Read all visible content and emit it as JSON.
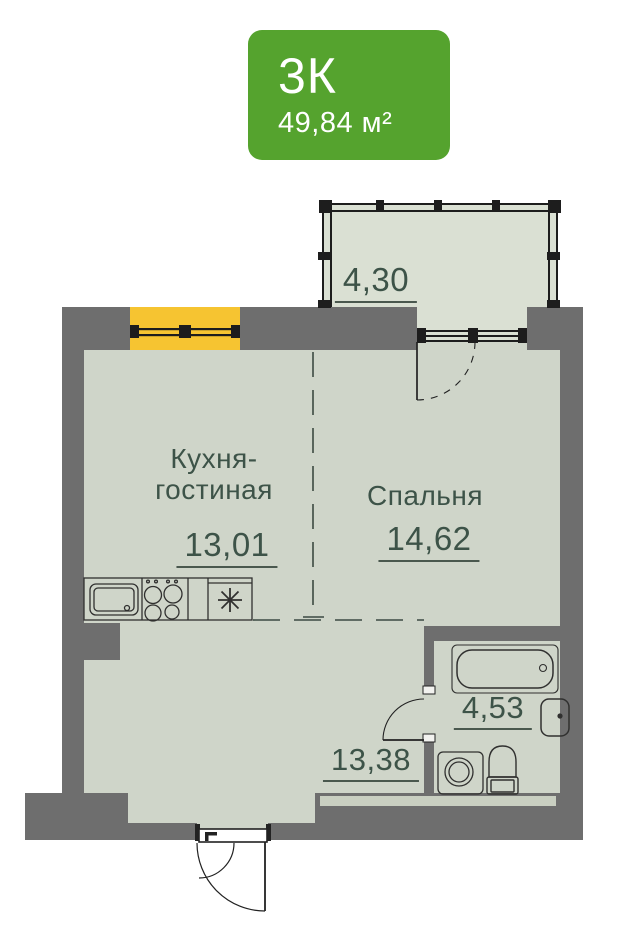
{
  "badge": {
    "rooms_label": "3К",
    "area_label": "49,84 м²"
  },
  "plan": {
    "balcony": {
      "area": "4,30"
    },
    "kitchen_living": {
      "name_line1": "Кухня-",
      "name_line2": "гостиная",
      "area": "13,01"
    },
    "bedroom": {
      "name": "Спальня",
      "area": "14,62"
    },
    "bathroom": {
      "area": "4,53"
    },
    "hallway": {
      "area": "13,38"
    }
  },
  "colors": {
    "badge_green": "#55a32e",
    "wall_gray": "#6e6e6e",
    "floor_sage": "#cfd5c9",
    "balcony_floor": "#dae0d3",
    "window_highlight_yellow": "#f6c431",
    "label_text": "#3d5348",
    "line_dark": "#2e2e2e"
  }
}
